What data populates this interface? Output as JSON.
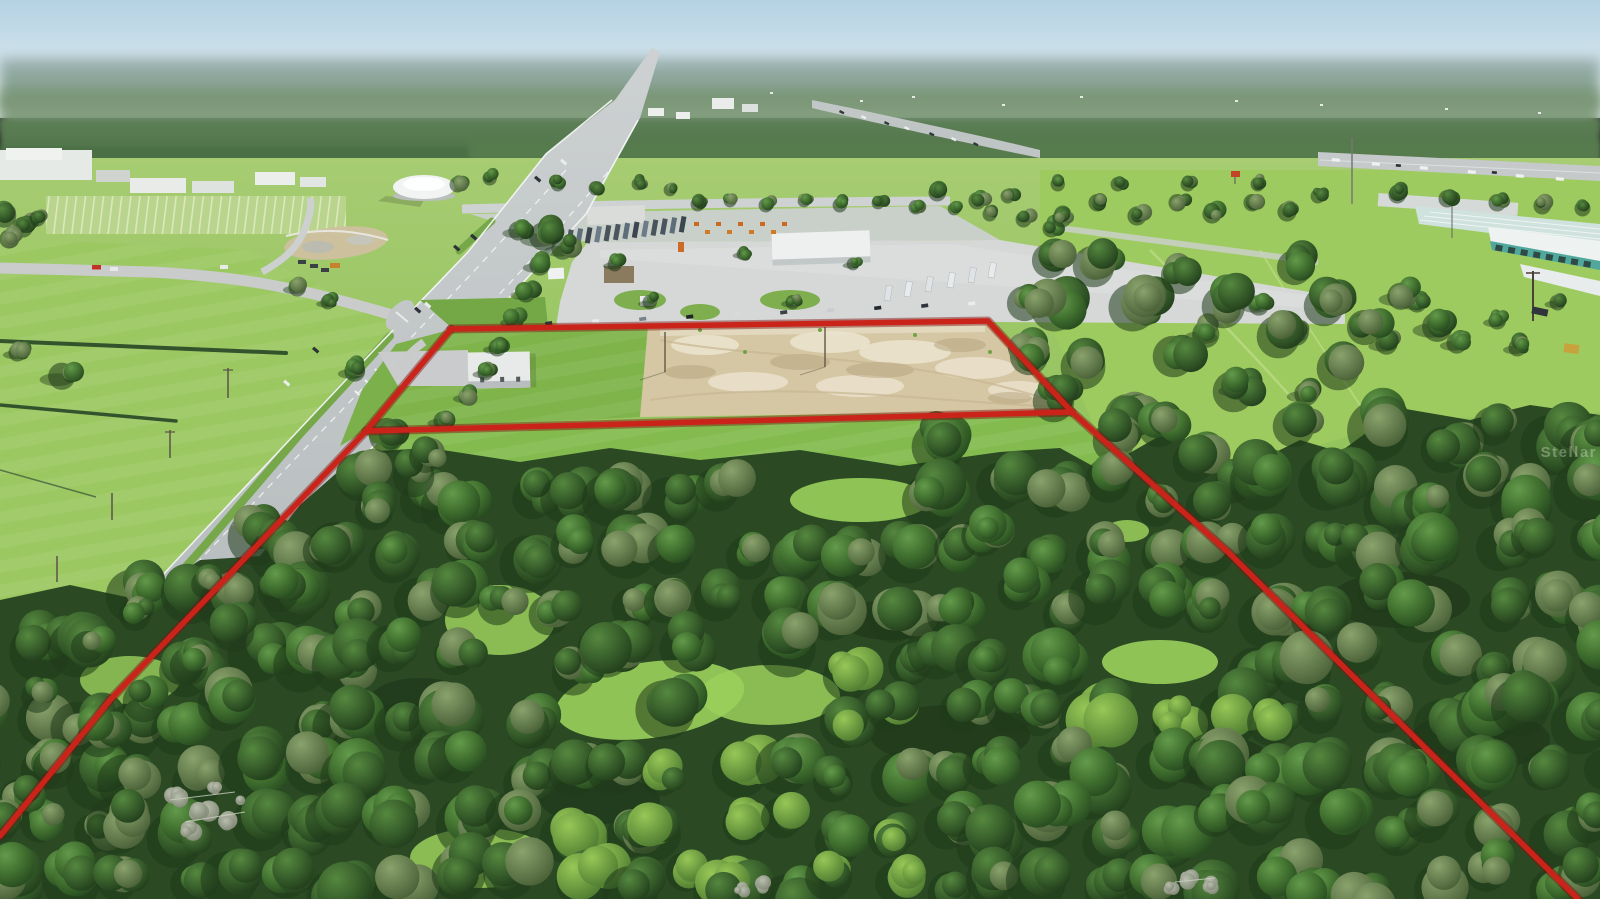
{
  "scene": {
    "description": "Aerial drone photo of a vacant land parcel outlined in red: cleared dirt pad and mowed grass strip along a commercial truck lot, dense oak woods to the south, a divided highway running to the lower left, distant interstate and storage facility upper right, hazy tree-line horizon."
  },
  "watermark": {
    "text": "Stellar"
  },
  "boundary": {
    "color": "#c9231a",
    "underlay_color": "#7e120e",
    "width": 5.5,
    "underlay_width": 9,
    "topright_points": "451,329 988,321 1072,412 1228,552 1390,713 1578,899",
    "left_points": "451,329 366,431 110,700 0,836",
    "inner_points": "366,431 1072,412"
  },
  "palette": {
    "sky_top": "#b4d2e4",
    "sky_horizon": "#e9f1f1",
    "far_haze": "#9db3b4",
    "far_forest": "#5a7e52",
    "field_green": "#8cc055",
    "field_light": "#a7cc72",
    "glade_green": "#9bd05c",
    "woods_base": "#2b4a24",
    "canopy_dark": "#27451f",
    "canopy_mid": "#41702f",
    "canopy_light": "#639a4b",
    "canopy_olive": "#8aa26c",
    "canopy_bright": "#97c757",
    "road_asphalt": "#b2b7b9",
    "lane_white": "#f4f6f6",
    "median_green": "#76a84a",
    "concrete": "#d6d8d8",
    "dirt_tan": "#d5c7a3",
    "sand_light": "#ece4d0",
    "equipment_orange": "#d07a28",
    "storage_teal": "#4fa89b",
    "storage_roof": "#cfe2dd",
    "trailer_grays": [
      "#4a5560",
      "#5d6e7a",
      "#3d464e",
      "#6b7c88",
      "#49535a"
    ],
    "car_colors": [
      "#2e3438",
      "#e9ecec",
      "#7b8288",
      "#1f2428",
      "#d7dadb",
      "#3a4145",
      "#caccce",
      "#23282c"
    ],
    "dead_tree_gray": [
      "#a8ad9c",
      "#8f957f",
      "#b5baa8"
    ]
  }
}
